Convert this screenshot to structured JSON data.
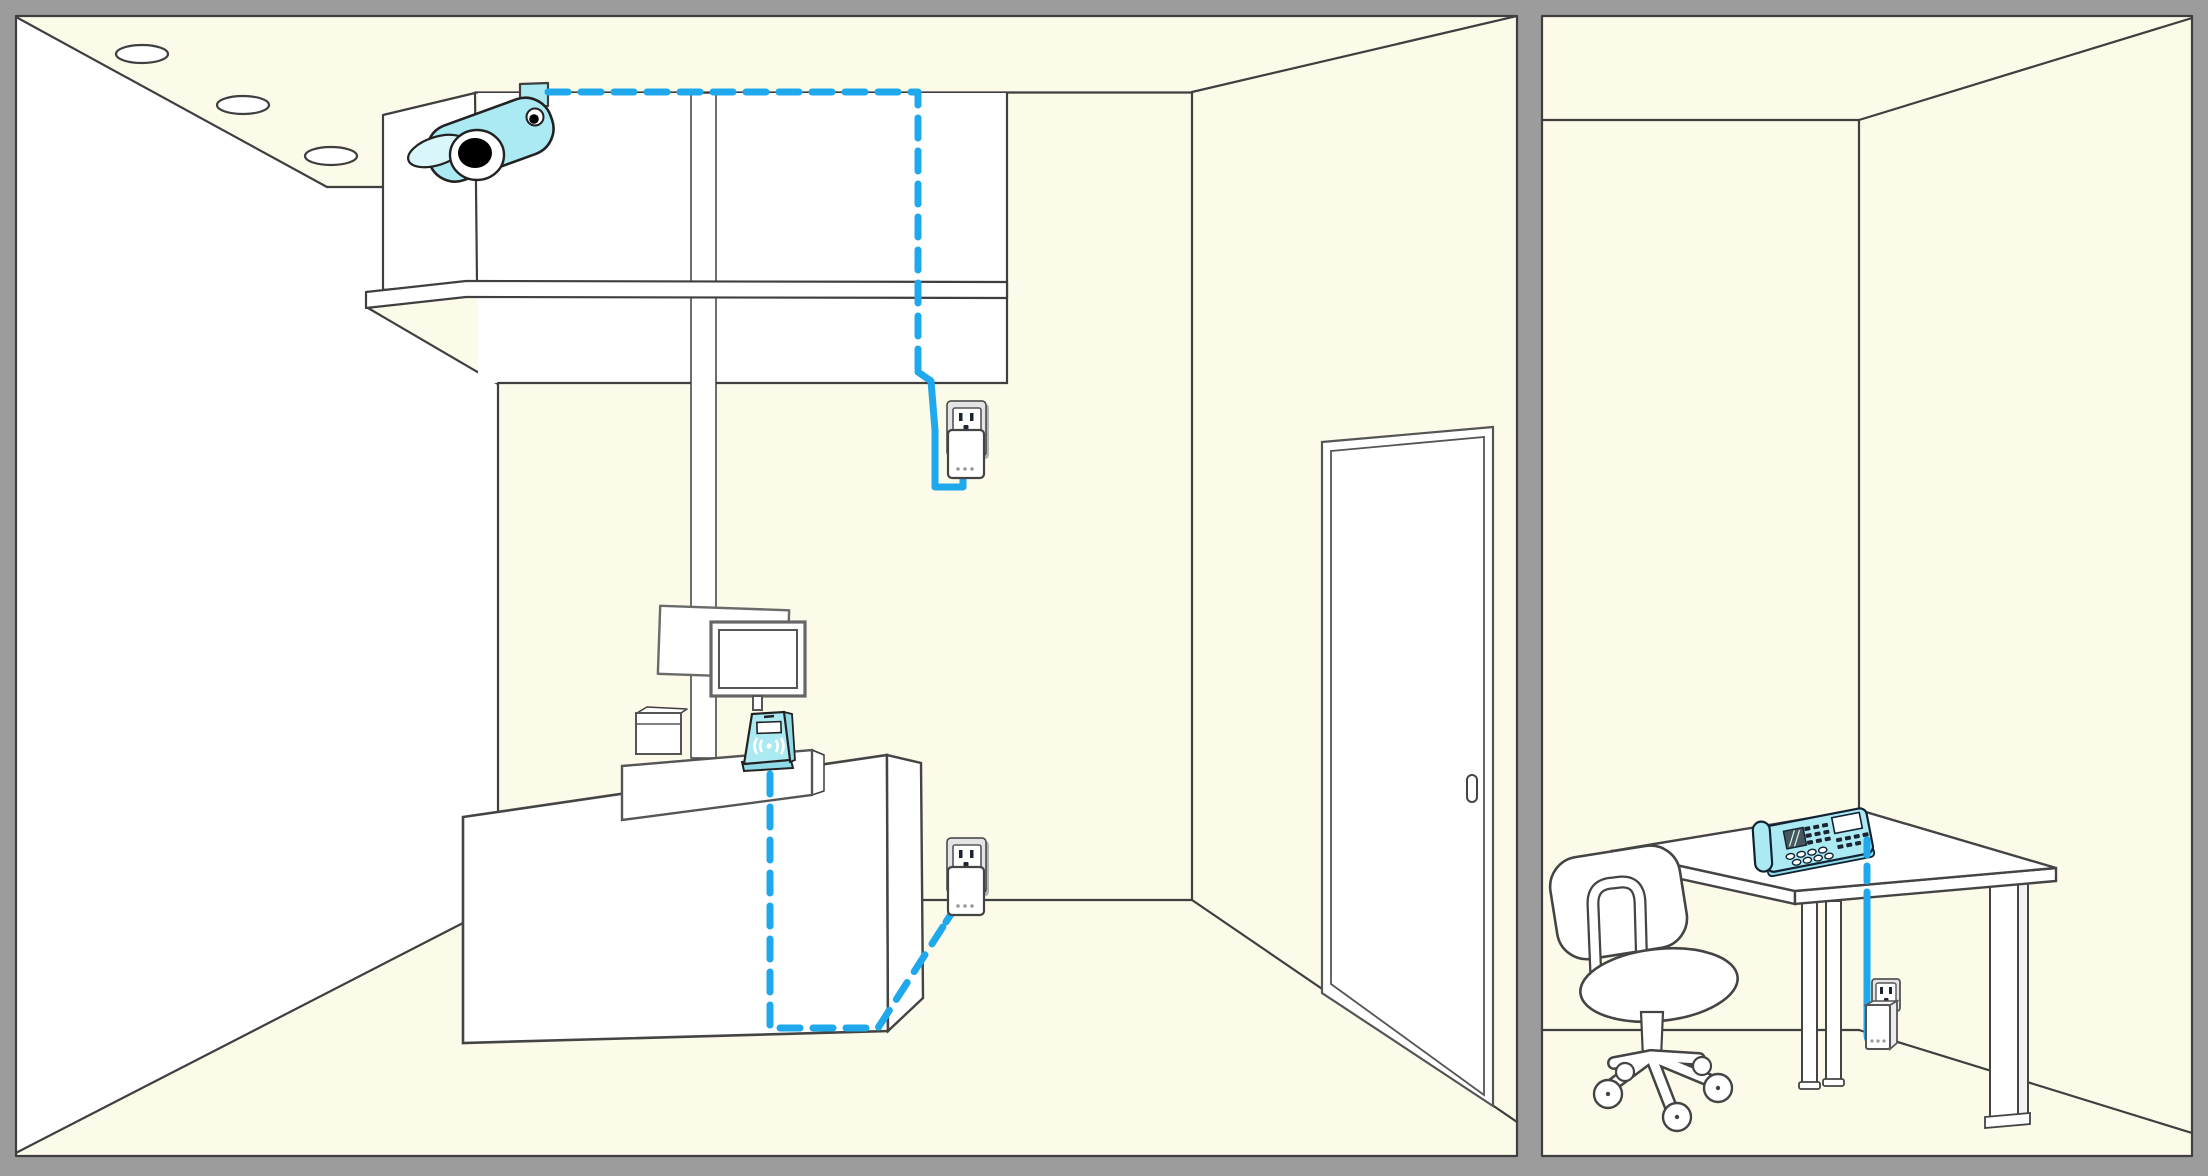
{
  "title": "two-room-powerline-network-illustration",
  "colors": {
    "cream": "#FCFAE8",
    "white": "#FFFFFF",
    "line": "#3F3F3F",
    "line-soft": "#6A6A6A",
    "frame": "#9C9C9C",
    "cyan": "#ABE9F3",
    "cyan-light": "#D9F6FA",
    "cyan-mid": "#8FDBE8",
    "cable": "#1FA8EC",
    "plate": "#E4E4E4",
    "plate-shadow": "#B3B3B3",
    "key-dark": "#1B2430"
  },
  "left_room": {
    "label": "store-room",
    "ceiling_light_count": 3,
    "objects": [
      "security-camera",
      "camera-shelf",
      "pos-counter",
      "pos-monitor",
      "receipt-printer",
      "menu-board",
      "contactless-card-reader",
      "power-outlet-upper",
      "powerline-adapter-upper",
      "power-outlet-lower",
      "powerline-adapter-lower",
      "sliding-door",
      "network-cable-camera",
      "network-cable-reader"
    ]
  },
  "right_room": {
    "label": "office-room",
    "objects": [
      "office-desk",
      "office-chair",
      "desk-phone",
      "power-outlet",
      "powerline-adapter",
      "network-cable-phone"
    ]
  },
  "cable_legend": {
    "hidden_run_style": "dashed",
    "visible_run_style": "solid"
  }
}
